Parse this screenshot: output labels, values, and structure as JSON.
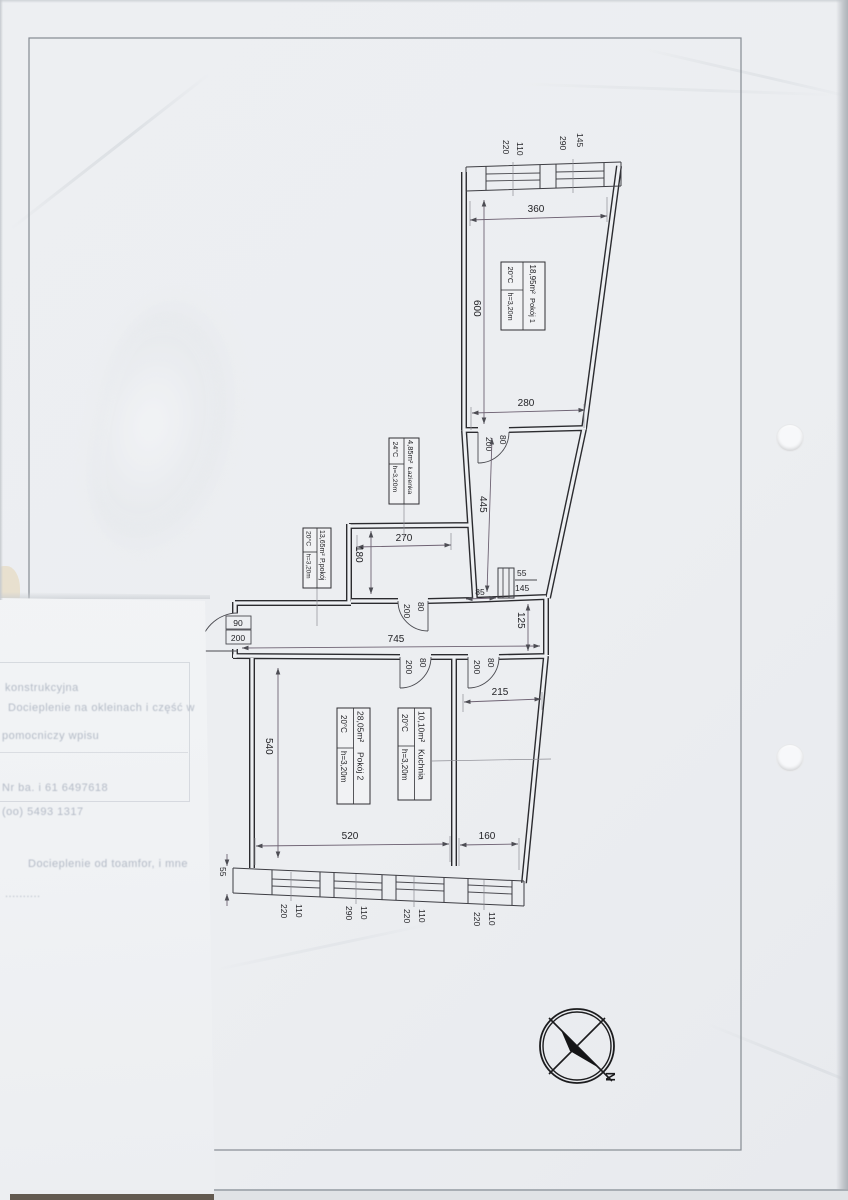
{
  "page": {
    "compass_label": "N"
  },
  "rooms": [
    {
      "area": "18,95m²",
      "name": "Pokój 1",
      "temp": "20°C",
      "height": "h=3,20m"
    },
    {
      "area": "4,85m²",
      "name": "Łazienka",
      "temp": "24°C",
      "height": "h=3,20m"
    },
    {
      "area": "13,65m²",
      "name": "P.pokój",
      "temp": "20°C",
      "height": "h=3,20m"
    },
    {
      "area": "28,05m²",
      "name": "Pokój 2",
      "temp": "20°C",
      "height": "h=3,20m"
    },
    {
      "area": "10,10m²",
      "name": "Kuchnia",
      "temp": "20°C",
      "height": "h=3,20m"
    }
  ],
  "dims": {
    "pokoj1_width": "360",
    "pokoj1_depth": "600",
    "pokoj1_bottom": "280",
    "top_windows": [
      "220",
      "110",
      "290",
      "145"
    ],
    "corridor_length": "445",
    "lazienka_width": "270",
    "lazienka_depth": "180",
    "shaft_gap": "85",
    "shaft": [
      "55",
      "145"
    ],
    "hall_length": "745",
    "hall_depth": "125",
    "entry_door": [
      "90",
      "200"
    ],
    "door": [
      "200",
      "80"
    ],
    "pokoj2_depth": "540",
    "pokoj2_width": "520",
    "kuchnia_top": "215",
    "kuchnia_bottom": "160",
    "wall_thickness": "55",
    "bottom_windows": [
      [
        "220",
        "110"
      ],
      [
        "290",
        "110"
      ],
      [
        "220",
        "110"
      ],
      [
        "220",
        "110"
      ]
    ]
  },
  "underlay": {
    "fragments": [
      "konstrukcyjna",
      "Docieplenie na okleinach i część w",
      "pomocniczy wpisu",
      "Nr ba. i 61 6497618",
      "(oo) 5493 1317",
      "Docieplenie od toamfor, i mne",
      ".........."
    ]
  }
}
